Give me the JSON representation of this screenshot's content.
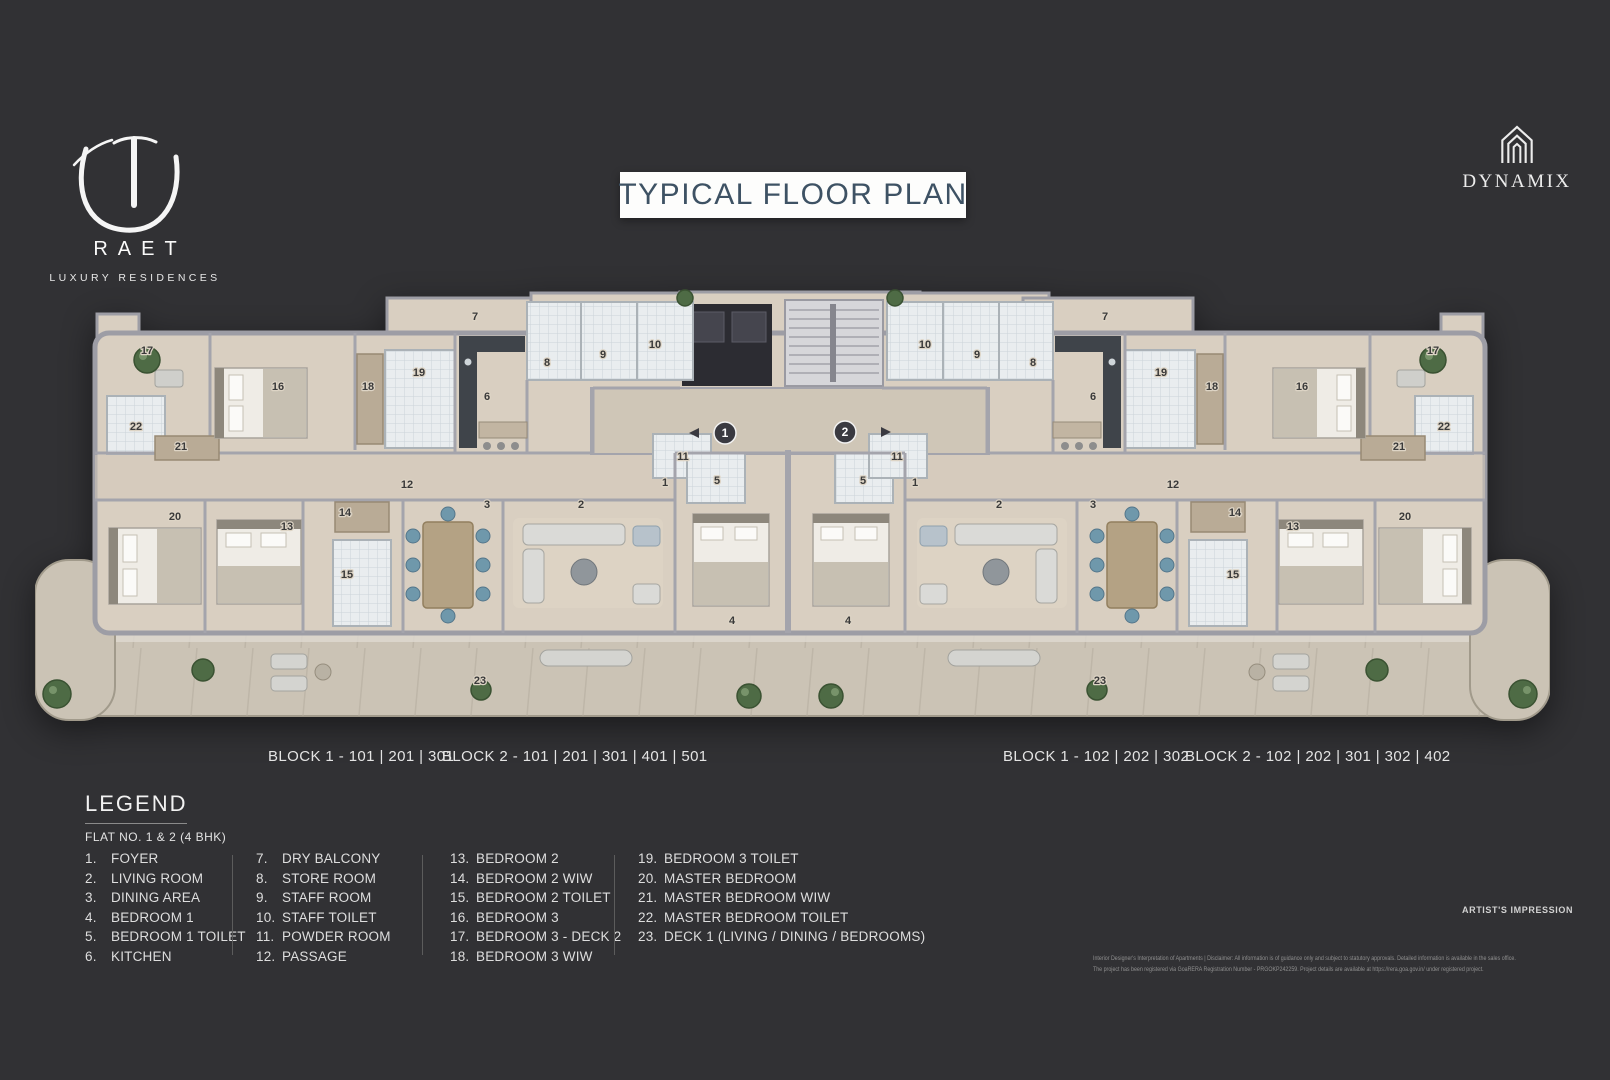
{
  "page": {
    "title_box": "TYPICAL FLOOR PLAN"
  },
  "brand": {
    "name": "RAET",
    "tagline": "LUXURY RESIDENCES"
  },
  "developer": {
    "name": "DYNAMIX"
  },
  "floorplan": {
    "unit_markers": [
      "1",
      "2"
    ],
    "block_labels": [
      "BLOCK 1 - 101 | 201 | 301",
      "BLOCK 2 - 101 | 201  | 301 | 401 | 501",
      "BLOCK 1 - 102 | 202 | 302",
      "BLOCK 2 - 102 | 202  | 301 | 302 | 402"
    ],
    "room_labels": [
      {
        "n": "17",
        "x": 112,
        "y": 66
      },
      {
        "n": "16",
        "x": 243,
        "y": 102
      },
      {
        "n": "18",
        "x": 333,
        "y": 102
      },
      {
        "n": "19",
        "x": 384,
        "y": 88
      },
      {
        "n": "7",
        "x": 440,
        "y": 32
      },
      {
        "n": "6",
        "x": 452,
        "y": 112
      },
      {
        "n": "8",
        "x": 512,
        "y": 78
      },
      {
        "n": "9",
        "x": 568,
        "y": 70
      },
      {
        "n": "10",
        "x": 620,
        "y": 60
      },
      {
        "n": "11",
        "x": 648,
        "y": 172
      },
      {
        "n": "22",
        "x": 101,
        "y": 142
      },
      {
        "n": "21",
        "x": 146,
        "y": 162
      },
      {
        "n": "12",
        "x": 372,
        "y": 200
      },
      {
        "n": "20",
        "x": 140,
        "y": 232
      },
      {
        "n": "13",
        "x": 252,
        "y": 242
      },
      {
        "n": "14",
        "x": 310,
        "y": 228
      },
      {
        "n": "15",
        "x": 312,
        "y": 290
      },
      {
        "n": "3",
        "x": 452,
        "y": 220
      },
      {
        "n": "2",
        "x": 546,
        "y": 220
      },
      {
        "n": "1",
        "x": 630,
        "y": 198
      },
      {
        "n": "5",
        "x": 682,
        "y": 196
      },
      {
        "n": "4",
        "x": 697,
        "y": 336
      },
      {
        "n": "23",
        "x": 445,
        "y": 396
      },
      {
        "n": "17",
        "x": 1398,
        "y": 66
      },
      {
        "n": "16",
        "x": 1267,
        "y": 102
      },
      {
        "n": "18",
        "x": 1177,
        "y": 102
      },
      {
        "n": "19",
        "x": 1126,
        "y": 88
      },
      {
        "n": "7",
        "x": 1070,
        "y": 32
      },
      {
        "n": "6",
        "x": 1058,
        "y": 112
      },
      {
        "n": "8",
        "x": 998,
        "y": 78
      },
      {
        "n": "9",
        "x": 942,
        "y": 70
      },
      {
        "n": "10",
        "x": 890,
        "y": 60
      },
      {
        "n": "11",
        "x": 862,
        "y": 172
      },
      {
        "n": "22",
        "x": 1409,
        "y": 142
      },
      {
        "n": "21",
        "x": 1364,
        "y": 162
      },
      {
        "n": "12",
        "x": 1138,
        "y": 200
      },
      {
        "n": "20",
        "x": 1370,
        "y": 232
      },
      {
        "n": "13",
        "x": 1258,
        "y": 242
      },
      {
        "n": "14",
        "x": 1200,
        "y": 228
      },
      {
        "n": "15",
        "x": 1198,
        "y": 290
      },
      {
        "n": "3",
        "x": 1058,
        "y": 220
      },
      {
        "n": "2",
        "x": 964,
        "y": 220
      },
      {
        "n": "1",
        "x": 880,
        "y": 198
      },
      {
        "n": "5",
        "x": 828,
        "y": 196
      },
      {
        "n": "4",
        "x": 813,
        "y": 336
      },
      {
        "n": "23",
        "x": 1065,
        "y": 396
      }
    ]
  },
  "legend": {
    "heading": "LEGEND",
    "subheading": "FLAT NO. 1 & 2 (4 BHK)",
    "columns": [
      [
        {
          "num": "1.",
          "label": "FOYER"
        },
        {
          "num": "2.",
          "label": "LIVING ROOM"
        },
        {
          "num": "3.",
          "label": "DINING AREA"
        },
        {
          "num": "4.",
          "label": "BEDROOM 1"
        },
        {
          "num": "5.",
          "label": "BEDROOM 1 TOILET"
        },
        {
          "num": "6.",
          "label": "KITCHEN"
        }
      ],
      [
        {
          "num": "7.",
          "label": "DRY BALCONY"
        },
        {
          "num": "8.",
          "label": "STORE ROOM"
        },
        {
          "num": "9.",
          "label": "STAFF ROOM"
        },
        {
          "num": "10.",
          "label": "STAFF TOILET"
        },
        {
          "num": "11.",
          "label": "POWDER ROOM"
        },
        {
          "num": "12.",
          "label": "PASSAGE"
        }
      ],
      [
        {
          "num": "13.",
          "label": "BEDROOM 2"
        },
        {
          "num": "14.",
          "label": "BEDROOM 2 WIW"
        },
        {
          "num": "15.",
          "label": "BEDROOM 2 TOILET"
        },
        {
          "num": "16.",
          "label": "BEDROOM 3"
        },
        {
          "num": "17.",
          "label": "BEDROOM 3 - DECK 2"
        },
        {
          "num": "18.",
          "label": "BEDROOM 3 WIW"
        }
      ],
      [
        {
          "num": "19.",
          "label": "BEDROOM 3 TOILET"
        },
        {
          "num": "20.",
          "label": "MASTER BEDROOM"
        },
        {
          "num": "21.",
          "label": "MASTER BEDROOM WIW"
        },
        {
          "num": "22.",
          "label": "MASTER BEDROOM TOILET"
        },
        {
          "num": "23.",
          "label": "DECK 1 (LIVING / DINING / BEDROOMS)"
        }
      ]
    ]
  },
  "footnotes": {
    "artists_impression": "ARTIST'S IMPRESSION",
    "disclaimer_line1": "Interior Designer's Interpretation of Apartments | Disclaimer: All information is of guidance only and subject to statutory approvals. Detailed information is available in the sales office.",
    "disclaimer_line2": "The project has been registered via GoaRERA Registration Number - PRGOKP242259. Project details are available at https://rera.goa.gov.in/ under registered project."
  }
}
